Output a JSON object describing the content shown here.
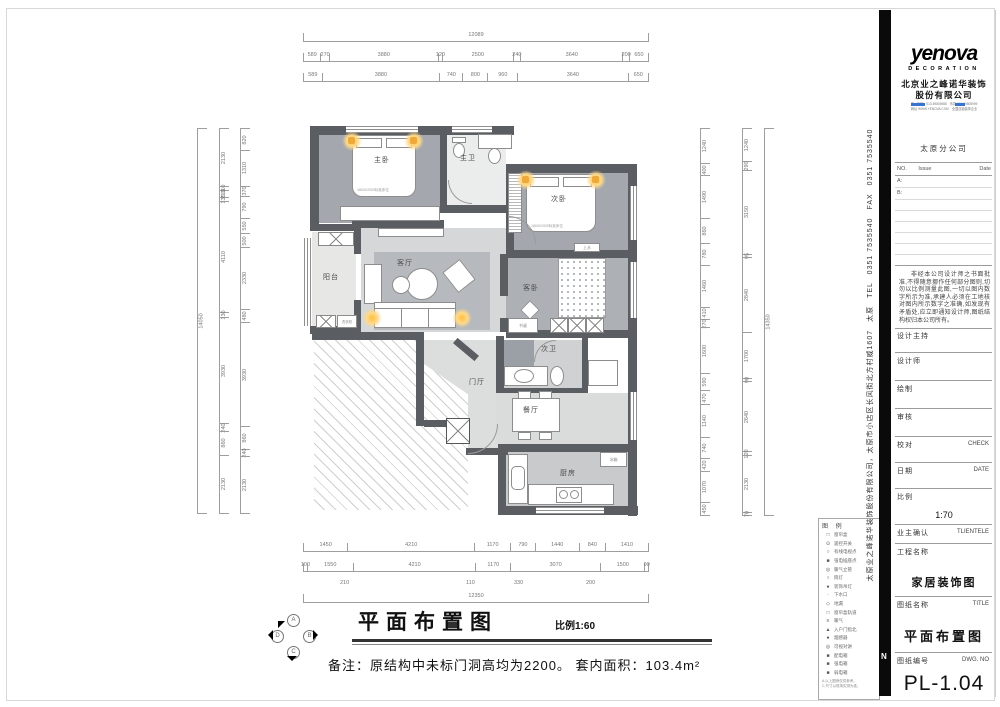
{
  "titleblock": {
    "logo": "yenova",
    "logo_sub": "DECORATION",
    "company_line1": "北京业之峰诺华装饰",
    "company_line2": "股份有限公司",
    "fine_print": [
      "电（总机）010-59805988　传真 010-59805999",
      "网址 WWW.YENOVA.COM　全国连锁装饰企业"
    ],
    "branch": "太原分公司",
    "revision_table": {
      "no": "NO.",
      "issue": "Issue",
      "date": "Date",
      "row_a": "A:",
      "row_b": "B:"
    },
    "disclaimer": "非经本公司设计师之书面批准,不得随意挪作任何部分图则,切勿以比例测量此图,一切以图内数字所示为准,承建人必须在工地核对图内所示数字之准确,如发现有矛盾处,应立即通知设计师,图纸结构权归本公司所有。",
    "fields": {
      "design_lead": "设计主持",
      "designer": "设计师",
      "draft": "绘制",
      "review": "审核",
      "check_cn": "校对",
      "check_en": "CHECK",
      "date_cn": "日期",
      "date_en": "DATE",
      "scale_cn": "比例",
      "scale_value": "1:70",
      "client_cn": "业主确认",
      "client_en": "TLIENTELE",
      "project_cn": "工程名称",
      "project_value": "家居装饰图",
      "sheet_cn": "图纸名称",
      "sheet_en": "TITLE",
      "sheet_value": "平面布置图",
      "dwg_cn": "图纸编号",
      "dwg_en": "DWG. NO",
      "dwg_value": "PL-1.04"
    },
    "side_text": "太原业之峰诺华装饰股份有限公司，太原市小店区长风街北方村威1607　太原　TEL　0351 7535540　FAX　0351 7535540"
  },
  "drawing_title": {
    "title": "平面布置图",
    "scale": "比例1:60",
    "note": "备注：原结构中未标门洞高均为2200。 套内面积：103.4m²",
    "compass": {
      "a": "A",
      "b": "B",
      "c": "C",
      "d": "D"
    }
  },
  "plan": {
    "rooms": {
      "master": "主卧",
      "master_bath": "主卫",
      "bed2": "次卧",
      "guest": "客卧",
      "balcony": "阳台",
      "living": "客厅",
      "foyer": "门厅",
      "bath2": "次卫",
      "dining": "餐厅",
      "kitchen": "厨房"
    },
    "sublabels": {
      "bed_size": "1800X2000标准床位",
      "water": "上水",
      "desk": "书桌",
      "fridge": "冰箱",
      "washer": "洗衣机"
    }
  },
  "dims": {
    "top": {
      "total": "12089",
      "row2": [
        "589",
        "270",
        "3880",
        "120",
        "2500",
        "240",
        "3640",
        "200",
        "650"
      ],
      "row3": [
        "589",
        "3880",
        "740",
        "800",
        "960",
        "3640",
        "650"
      ]
    },
    "bottom": {
      "row1": [
        "1450",
        "4210",
        "1170",
        "790",
        "1440",
        "840",
        "1410"
      ],
      "row2": [
        "100",
        "1550",
        "4210",
        "1170",
        "3070",
        "1500",
        "90"
      ],
      "callouts": [
        "210",
        "110",
        "330",
        "200"
      ],
      "total": "12350"
    },
    "left": {
      "total": "14050",
      "col2": [
        "2130",
        "110",
        "210",
        "130",
        "4110",
        "130",
        "3930",
        "240",
        "860",
        "2130"
      ],
      "col3": [
        "820",
        "1310",
        "370",
        "790",
        "550",
        "500",
        "2330",
        "480",
        "3930",
        "860",
        "240",
        "2130"
      ]
    },
    "right": {
      "total": "14350",
      "mid": [
        "1240",
        "290",
        "3150",
        "95",
        "2840",
        "1700",
        "90",
        "2640",
        "120",
        "2130",
        "70"
      ],
      "inner": [
        "1240",
        "400",
        "1490",
        "860",
        "780",
        "1460",
        "410",
        "270",
        "1600",
        "590",
        "470",
        "1140",
        "740",
        "420",
        "1070",
        "450"
      ]
    }
  },
  "legend": {
    "title": "图 例",
    "items": [
      {
        "sym": "□",
        "label": "窗帘盒"
      },
      {
        "sym": "⊙",
        "label": "遥控开关"
      },
      {
        "sym": "○",
        "label": "有线电视点"
      },
      {
        "sym": "■",
        "label": "强电插座点"
      },
      {
        "sym": "◎",
        "label": "暖气立管"
      },
      {
        "sym": "○",
        "label": "筒灯"
      },
      {
        "sym": "●",
        "label": "装饰吊灯"
      },
      {
        "sym": "·",
        "label": "下水口"
      },
      {
        "sym": "◇",
        "label": "地漏"
      },
      {
        "sym": "□",
        "label": "窗帘盒轨道"
      },
      {
        "sym": "≡",
        "label": "暖气"
      },
      {
        "sym": "▲",
        "label": "入户门指北"
      },
      {
        "sym": "●",
        "label": "烟感器"
      },
      {
        "sym": "◎",
        "label": "可视对讲"
      },
      {
        "sym": "■",
        "label": "配电箱"
      },
      {
        "sym": "■",
        "label": "强电箱"
      },
      {
        "sym": "■",
        "label": "弱电箱"
      }
    ],
    "notes": [
      "A.以上图例仅供参考。",
      "C.尺寸以现场实测为准。"
    ]
  }
}
